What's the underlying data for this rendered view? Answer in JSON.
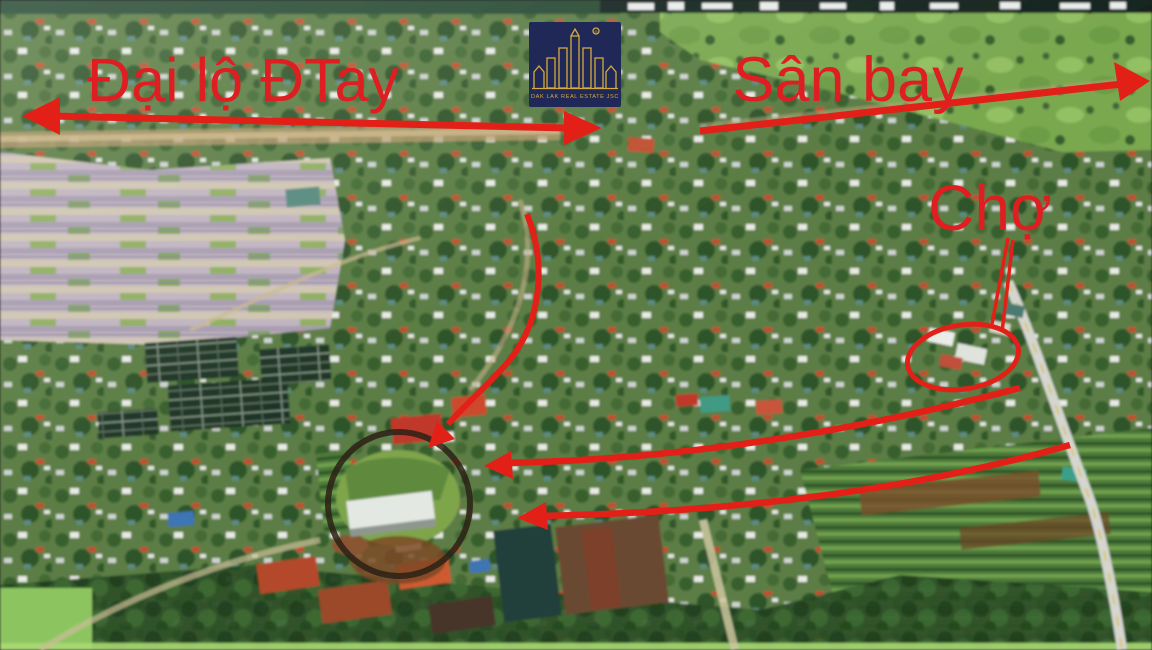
{
  "colors": {
    "annotation_red": "#e22018",
    "text_red": "#df1e22",
    "logo_navy": "#1f2857",
    "logo_gold": "#d7ab3c",
    "plot_ring_dark": "#2b2115"
  },
  "logo": {
    "company": "DAK LAK REAL ESTATE JSC",
    "registered": "®"
  },
  "labels": {
    "boulevard": "Đại lộ ĐTay",
    "airport": "Sân bay",
    "market": "Chợ"
  },
  "icons": {
    "boulevard_arrow": "double-headed-arrow",
    "airport_arrow": "right-arrow",
    "route_arrow_upper": "left-arrow",
    "route_arrow_lower": "left-arrow",
    "plot_arrow": "curved-down-left-arrow",
    "market_pointer": "pointer-lines",
    "market_circle": "highlight-ellipse",
    "plot_circle": "dark-highlight-ring",
    "logo_icon": "towers-building-emblem"
  }
}
